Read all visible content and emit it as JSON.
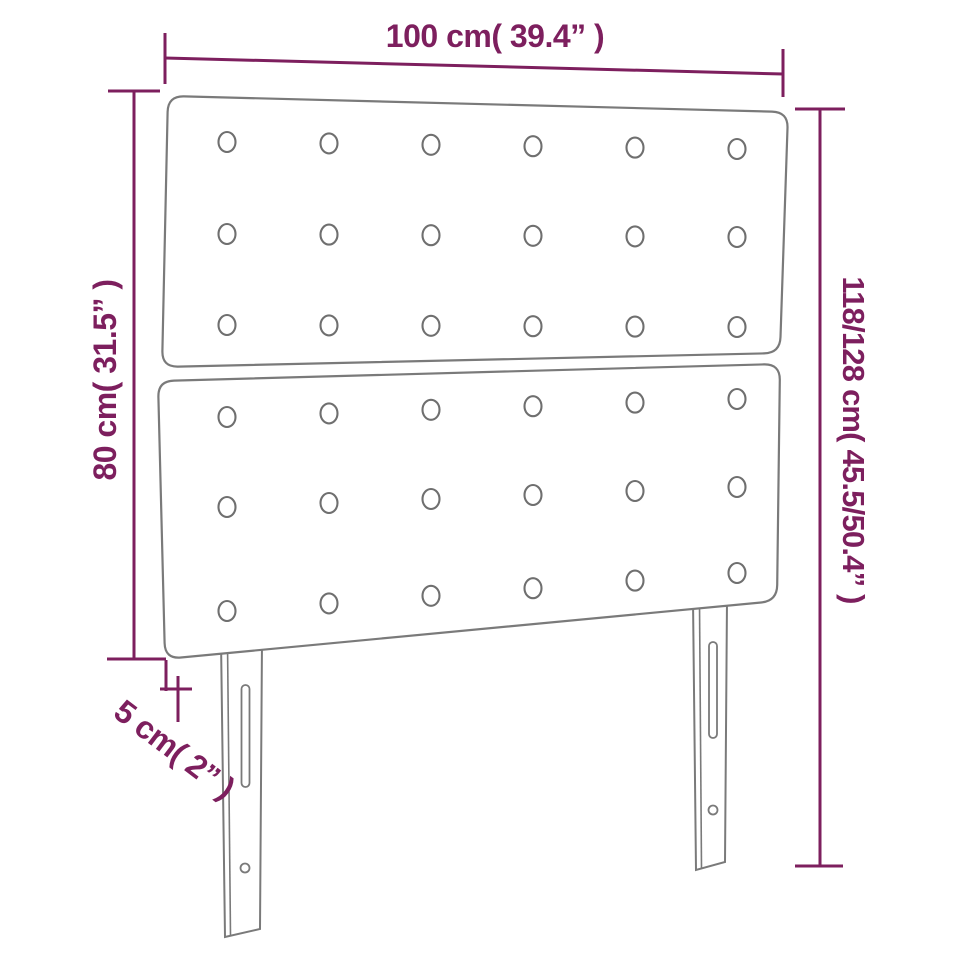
{
  "diagram": {
    "type": "product-dimension-diagram",
    "subject": "upholstered headboard with two tufted panels and two slotted legs",
    "colors": {
      "dimension_accent": "#7d1f5e",
      "outline_gray": "#7a7a7a",
      "background": "#ffffff"
    },
    "dimensions": {
      "width": "100 cm( 39.4” )",
      "left_height": "80 cm( 31.5” )",
      "right_height": "118/128 cm( 45.5/50.4” )",
      "thickness": "5 cm( 2” )"
    },
    "tufting": {
      "panels": 2,
      "rows_per_panel": 3,
      "buttons_per_row": 6
    }
  }
}
